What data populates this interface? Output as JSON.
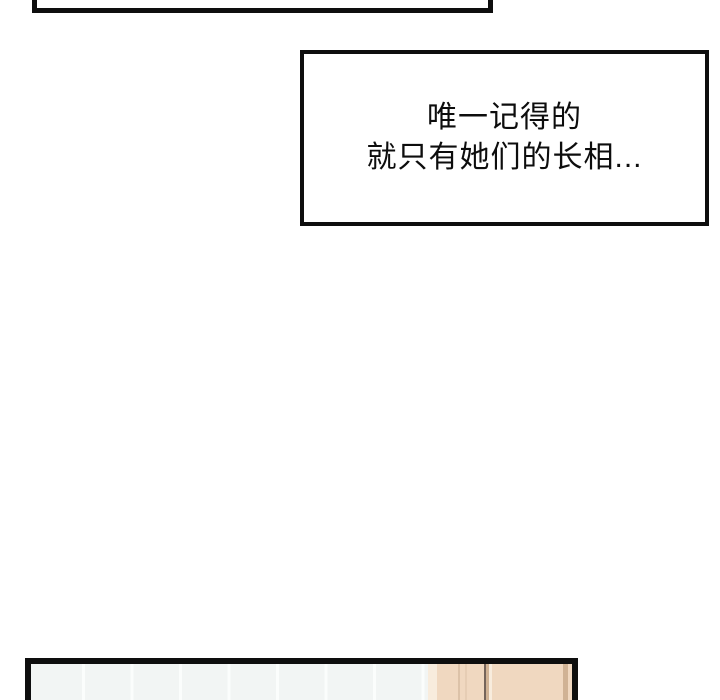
{
  "colors": {
    "page-bg": "#ffffff",
    "ink": "#0e0e0e",
    "text": "#0d0d0d",
    "tile": "#f2f5f4",
    "tile-seam": "#fbfdfc",
    "door": "#f0d8c0",
    "door-edge-light": "#f8ecdd",
    "door-line-soft": "#dcc2a8",
    "door-line-soft2": "#e6cdb4",
    "door-line-dark": "#75645a",
    "door-line-mid": "#d0b294"
  },
  "caption": {
    "lines": [
      "唯一记得的",
      "就只有她们的长相..."
    ]
  }
}
